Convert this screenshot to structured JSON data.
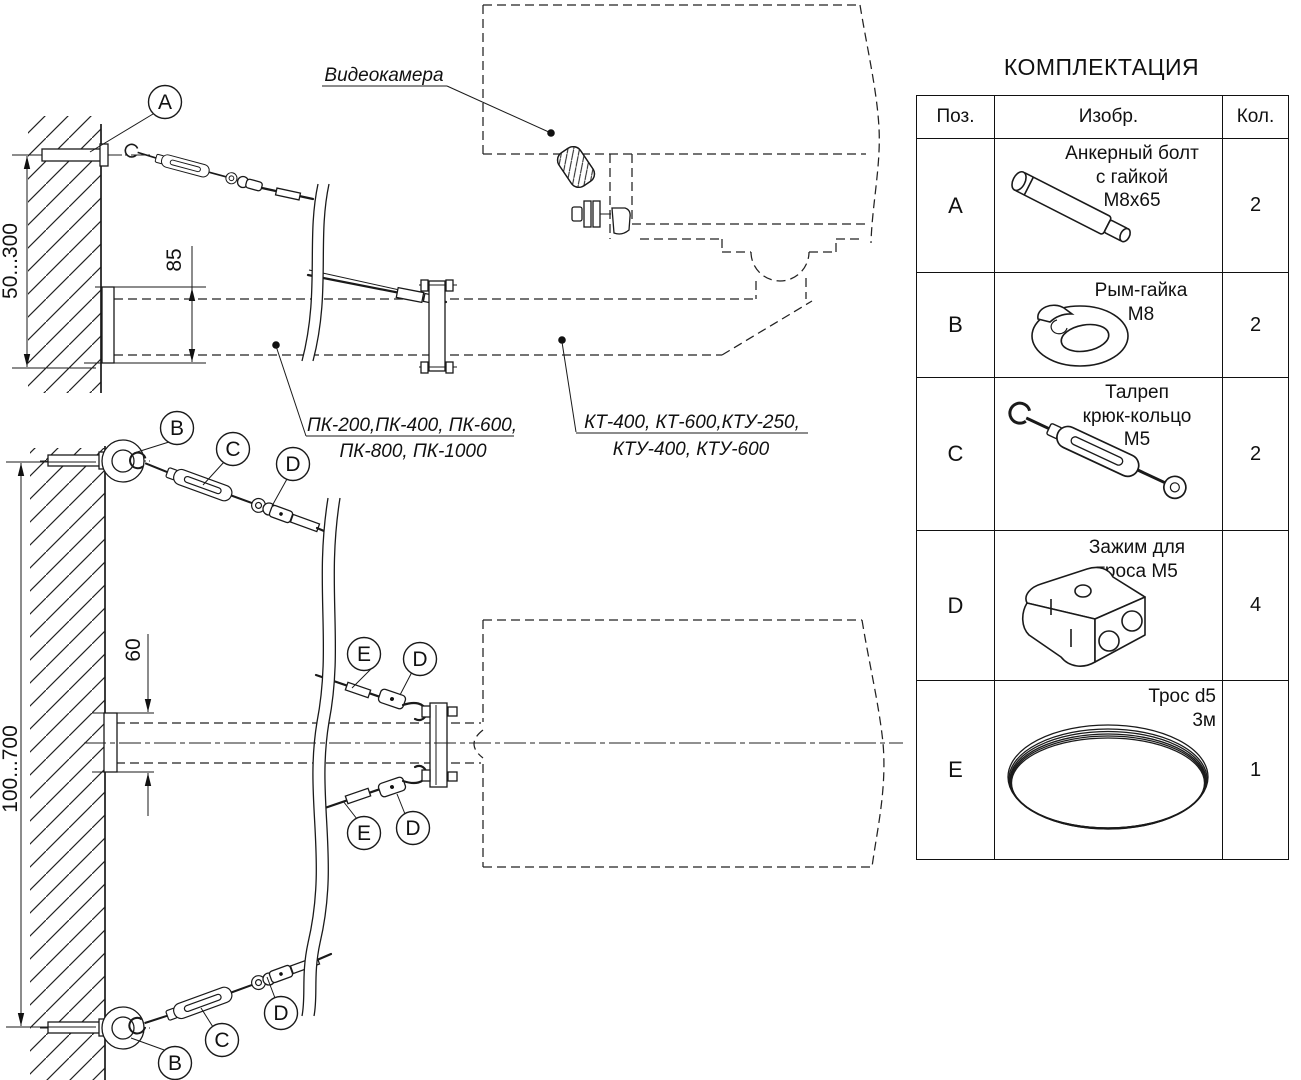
{
  "title": "КОМПЛЕКТАЦИЯ",
  "parts_table": {
    "headers": {
      "pos": "Поз.",
      "image": "Изобр.",
      "qty": "Кол."
    },
    "rows": [
      {
        "pos": "A",
        "icon": "anchor-bolt-icon",
        "desc": [
          "Анкерный болт",
          "с гайкой",
          "М8х65"
        ],
        "qty": "2"
      },
      {
        "pos": "B",
        "icon": "eye-nut-icon",
        "desc": [
          "Рым-гайка",
          "М8"
        ],
        "qty": "2"
      },
      {
        "pos": "C",
        "icon": "turnbuckle-icon",
        "desc": [
          "Талреп",
          "крюк-кольцо",
          "М5"
        ],
        "qty": "2"
      },
      {
        "pos": "D",
        "icon": "cable-clamp-icon",
        "desc": [
          "Зажим для",
          "троса М5"
        ],
        "qty": "4"
      },
      {
        "pos": "E",
        "icon": "cable-coil-icon",
        "desc": [
          "Трос d5",
          "3м"
        ],
        "qty": "1"
      }
    ]
  },
  "diagram": {
    "camera_label": "Видеокамера",
    "bracket_models": {
      "line1": "ПК-200,ПК-400, ПК-600,",
      "line2": "ПК-800, ПК-1000"
    },
    "mount_models": {
      "line1": "КТ-400, КТ-600,КТУ-250,",
      "line2": "КТУ-400, КТУ-600"
    },
    "dimensions": {
      "upper_offset": "50...300",
      "upper_plate": "85",
      "lower_offset": "100...700",
      "lower_plate": "60"
    },
    "callouts": {
      "a": "A",
      "b": "B",
      "c": "C",
      "d": "D",
      "e": "E"
    }
  }
}
